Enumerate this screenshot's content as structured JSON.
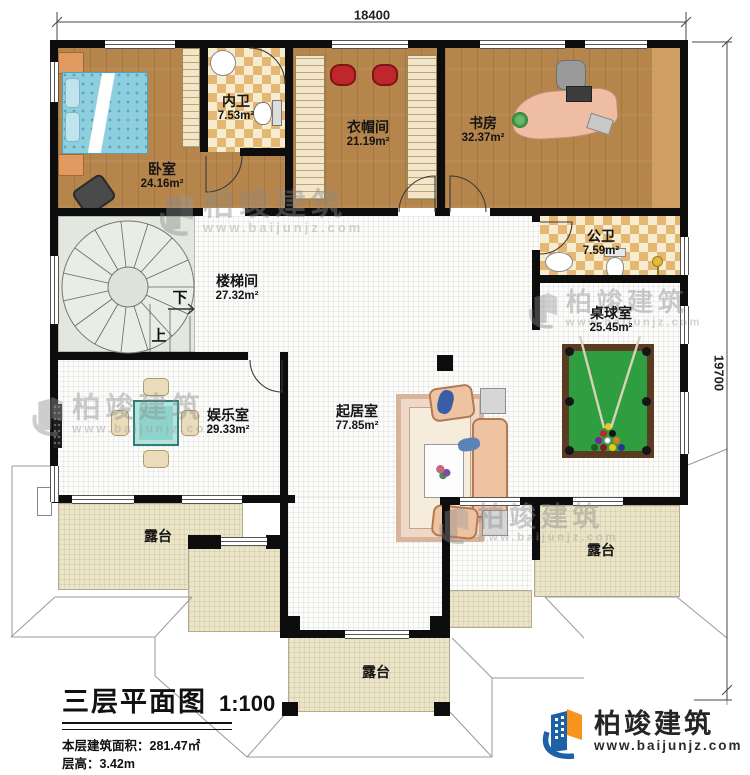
{
  "plan": {
    "title": "三层平面图",
    "scale": "1:100",
    "area_label": "本层建筑面积：",
    "area_value": "281.47㎡",
    "floor_height_label": "层高：",
    "floor_height_value": "3.42m"
  },
  "dimensions": {
    "width": "18400",
    "height": "19700"
  },
  "brand": {
    "name": "柏竣建筑",
    "website": "www.baijunjz.com"
  },
  "stairs": {
    "down": "下",
    "up": "上"
  },
  "rooms": [
    {
      "name": "卧室",
      "area": "24.16m²"
    },
    {
      "name": "内卫",
      "area": "7.53m²"
    },
    {
      "name": "衣帽间",
      "area": "21.19m²"
    },
    {
      "name": "书房",
      "area": "32.37m²"
    },
    {
      "name": "公卫",
      "area": "7.59m²"
    },
    {
      "name": "楼梯间",
      "area": "27.32m²"
    },
    {
      "name": "桌球室",
      "area": "25.45m²"
    },
    {
      "name": "娱乐室",
      "area": "29.33m²"
    },
    {
      "name": "起居室",
      "area": "77.85m²"
    },
    {
      "name": "露台"
    },
    {
      "name": "露台"
    },
    {
      "name": "露台"
    }
  ],
  "colors": {
    "wall": "#0d0d0d",
    "wood_floor": "#b5854c",
    "tile": "#e4b873",
    "terrace": "#ece4c6",
    "pool_felt": "#2f9e41",
    "logo_blue": "#1b62a8",
    "logo_orange": "#f7941d"
  }
}
